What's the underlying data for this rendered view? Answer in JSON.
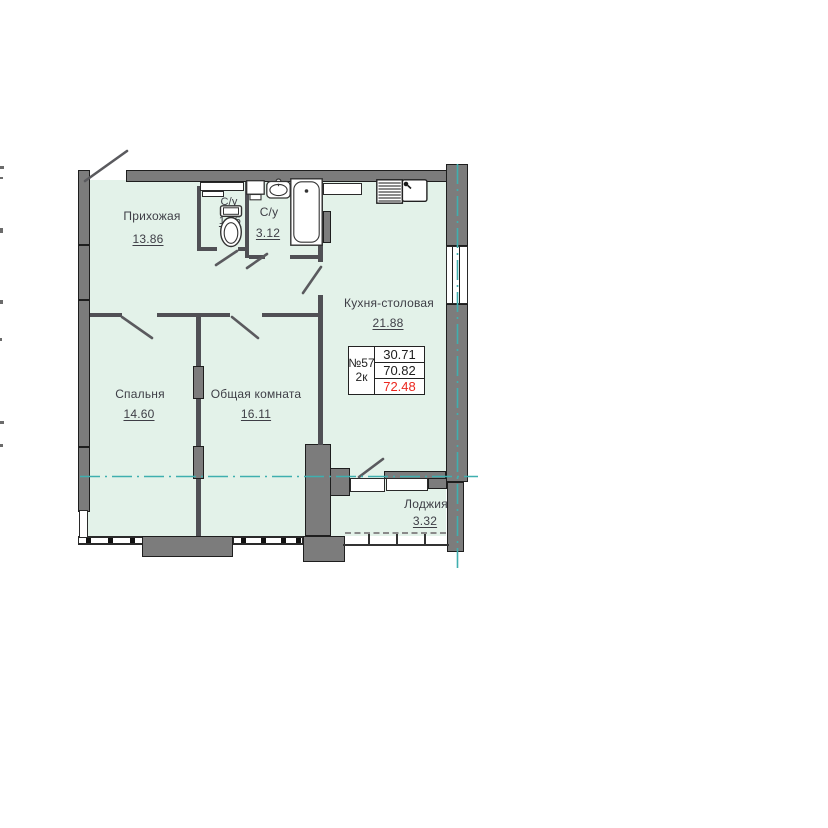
{
  "rooms": [
    {
      "id": "hallway",
      "name": "Прихожая",
      "area": "13.86"
    },
    {
      "id": "wc-small",
      "name": "С/у",
      "area": "1.25"
    },
    {
      "id": "wc-large",
      "name": "С/у",
      "area": "3.12"
    },
    {
      "id": "kitchen",
      "name": "Кухня-столовая",
      "area": "21.88"
    },
    {
      "id": "bedroom",
      "name": "Спальня",
      "area": "14.60"
    },
    {
      "id": "living-room",
      "name": "Общая комната",
      "area": "16.11"
    },
    {
      "id": "loggia",
      "name": "Лоджия",
      "area": "3.32"
    }
  ],
  "info_table": {
    "apartment_number": "№57",
    "rooms_count": "2к",
    "living_area": "30.71",
    "total_area": "70.82",
    "total_with_loggia": "72.48"
  },
  "colors": {
    "room_fill": "#e3f2e9",
    "wall_gray": "#7c7c7c",
    "wall_dark": "#505055",
    "axis_teal": "#3fafaf",
    "text_color": "#3e3e46",
    "highlight_red": "#ec2820"
  },
  "icons": [
    "entrance-door-swing",
    "toilet-icon",
    "bath-sink-icon",
    "bathtub-icon",
    "washing-machine-icon",
    "kitchen-sink-icon"
  ]
}
